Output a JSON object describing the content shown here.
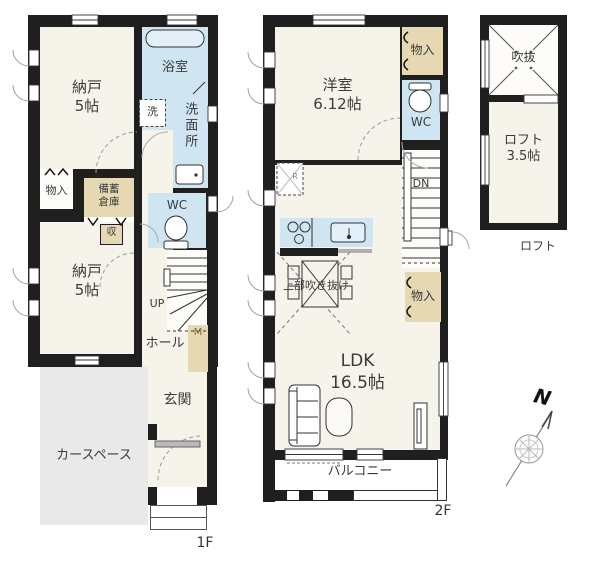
{
  "colors": {
    "wall": "#1f1f1f",
    "room_cream": "#f6f3eb",
    "water_blue": "#cfe5f1",
    "storage_tan": "#e5d8b2",
    "carspace_gray": "#e9e9e9",
    "text": "#3a3a3a"
  },
  "floor1": {
    "floor_label": "1F",
    "nando_top": "納戸\n5帖",
    "bath": "浴室",
    "washroom": "洗面所",
    "washer": "洗",
    "monoire": "物入",
    "bichiku": "備蓄\n倉庫",
    "shuno": "収",
    "wc": "WC",
    "nando_bottom": "納戸\n5帖",
    "up": "UP",
    "meter": "M",
    "hall": "ホール",
    "genkan": "玄関",
    "carspace": "カースペース"
  },
  "floor2": {
    "floor_label": "2F",
    "yoshitsu": "洋室\n6.12帖",
    "monoire_top": "物入",
    "wc": "WC",
    "dn": "DN",
    "fridge": "R",
    "void_label": "上部吹き抜け",
    "monoire_bottom": "物入",
    "ldk": "LDK\n16.5帖",
    "balcony": "バルコニー"
  },
  "loft": {
    "caption": "ロフト",
    "void": "吹抜",
    "room": "ロフト\n3.5帖"
  },
  "compass": {
    "north": "N"
  },
  "icons": {
    "bathtub-icon": "rounded-rect",
    "toilet-icon": "ellipse-with-tank",
    "washbasin-icon": "rounded-rect-with-faucet-dot",
    "washer-space-icon": "dashed-box",
    "refrigerator-space-icon": "dashed-box-with-R",
    "kitchen-counter-icon": "stove-circles-and-sink",
    "dining-table-icon": "square-with-chairs",
    "sofa-icon": "rounded-rect-cushions",
    "tv-board-icon": "slim-rect",
    "stairs-icon": "step-lines",
    "window-icon": "white-gap-with-swing-arc",
    "compass-icon": "rose-circle-with-needle"
  }
}
